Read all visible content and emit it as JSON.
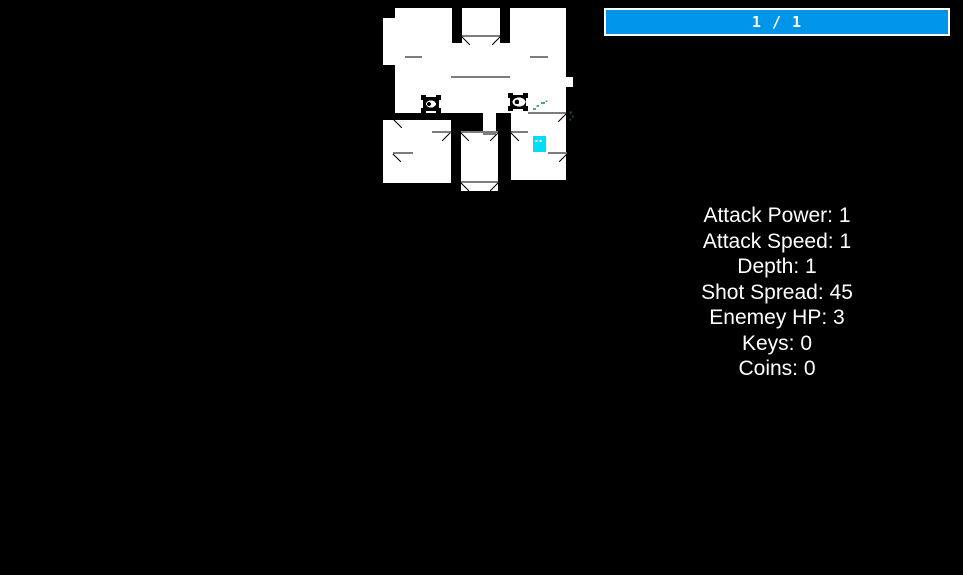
{
  "hud": {
    "hp_bar": {
      "label": "1 / 1",
      "current": 1,
      "max": 1,
      "fill_color": "#0095e8",
      "border_color": "#ffffff"
    }
  },
  "stats": {
    "items": [
      {
        "label": "Attack Power:",
        "value": "1"
      },
      {
        "label": "Attack Speed:",
        "value": "1"
      },
      {
        "label": "Depth:",
        "value": "1"
      },
      {
        "label": "Shot Spread:",
        "value": "45"
      },
      {
        "label": "Enemey HP:",
        "value": "3"
      },
      {
        "label": "Keys:",
        "value": "0"
      },
      {
        "label": "Coins:",
        "value": "0"
      }
    ]
  },
  "map": {
    "x": 383,
    "y": 0,
    "width": 192,
    "height": 192,
    "colors": {
      "floor": "#ffffff",
      "wall": "#000000",
      "line": "#7d7d7d",
      "player": "#00ddf6",
      "enemy": "#000000",
      "eye": "#ffffff",
      "pupil": "#000000",
      "particle_light": "#55a18b",
      "particle_dark": "#1d5a4b"
    },
    "floors": [
      [
        12,
        8,
        57,
        105
      ],
      [
        0,
        18,
        12,
        47
      ],
      [
        79,
        8,
        38,
        35
      ],
      [
        127,
        8,
        56,
        105
      ],
      [
        183,
        77,
        7,
        10
      ],
      [
        12,
        43,
        171,
        70
      ],
      [
        0,
        120,
        68,
        63
      ],
      [
        78,
        133,
        37,
        58
      ],
      [
        100,
        113,
        13,
        22
      ],
      [
        128,
        113,
        55,
        67
      ]
    ],
    "lines": [
      [
        79,
        35,
        38
      ],
      [
        22,
        56,
        17
      ],
      [
        147,
        56,
        18
      ],
      [
        68,
        76,
        59
      ],
      [
        145,
        112,
        38
      ],
      [
        49,
        131,
        19
      ],
      [
        78,
        131,
        37
      ],
      [
        128,
        131,
        17
      ],
      [
        100,
        133,
        13
      ],
      [
        10,
        152,
        20
      ],
      [
        165,
        152,
        19
      ],
      [
        78,
        181,
        37
      ]
    ],
    "walls": [
      [
        69,
        0,
        10,
        43
      ],
      [
        117,
        0,
        10,
        43
      ],
      [
        0,
        113,
        100,
        7
      ],
      [
        68,
        120,
        10,
        75
      ],
      [
        115,
        133,
        13,
        62
      ]
    ],
    "frames": [
      [
        79,
        37,
        87,
        45
      ],
      [
        117,
        37,
        109,
        45
      ],
      [
        11,
        120,
        19,
        128
      ],
      [
        67,
        133,
        59,
        141
      ],
      [
        78,
        133,
        86,
        141
      ],
      [
        115,
        133,
        107,
        141
      ],
      [
        128,
        133,
        136,
        141
      ],
      [
        10,
        154,
        18,
        162
      ],
      [
        184,
        154,
        176,
        162
      ],
      [
        183,
        114,
        175,
        122
      ],
      [
        78,
        183,
        86,
        191
      ],
      [
        115,
        183,
        107,
        191
      ]
    ],
    "enemies": [
      {
        "x": 38,
        "y": 95,
        "w": 20,
        "h": 18,
        "eye": {
          "cx": 48,
          "cy": 104,
          "rx": 5,
          "ry": 3.5
        },
        "pupil": {
          "cx": 46,
          "cy": 104,
          "r": 2
        }
      },
      {
        "x": 125,
        "y": 93,
        "w": 20,
        "h": 18,
        "eye": {
          "cx": 136,
          "cy": 102,
          "rx": 6.5,
          "ry": 4.5
        },
        "pupil": {
          "cx": 134,
          "cy": 102,
          "r": 2.3
        }
      }
    ],
    "player": {
      "x": 150,
      "y": 136,
      "w": 13,
      "h": 16,
      "eyes": [
        [
          152.5,
          140
        ],
        [
          156.5,
          140
        ]
      ]
    },
    "particles": [
      {
        "x": 150,
        "y": 108,
        "w": 3,
        "h": 2,
        "shade": "light"
      },
      {
        "x": 153.5,
        "y": 105,
        "w": 2.5,
        "h": 2,
        "shade": "light"
      },
      {
        "x": 158,
        "y": 102,
        "w": 4,
        "h": 2,
        "shade": "light"
      },
      {
        "x": 162.5,
        "y": 100.5,
        "w": 2,
        "h": 1.5,
        "shade": "light"
      },
      {
        "x": 186.5,
        "y": 111.5,
        "w": 2,
        "h": 2,
        "shade": "dark"
      },
      {
        "x": 189,
        "y": 115.5,
        "w": 1.5,
        "h": 2,
        "shade": "dark"
      },
      {
        "x": 186.5,
        "y": 119,
        "w": 1.5,
        "h": 1.5,
        "shade": "dark"
      }
    ]
  }
}
